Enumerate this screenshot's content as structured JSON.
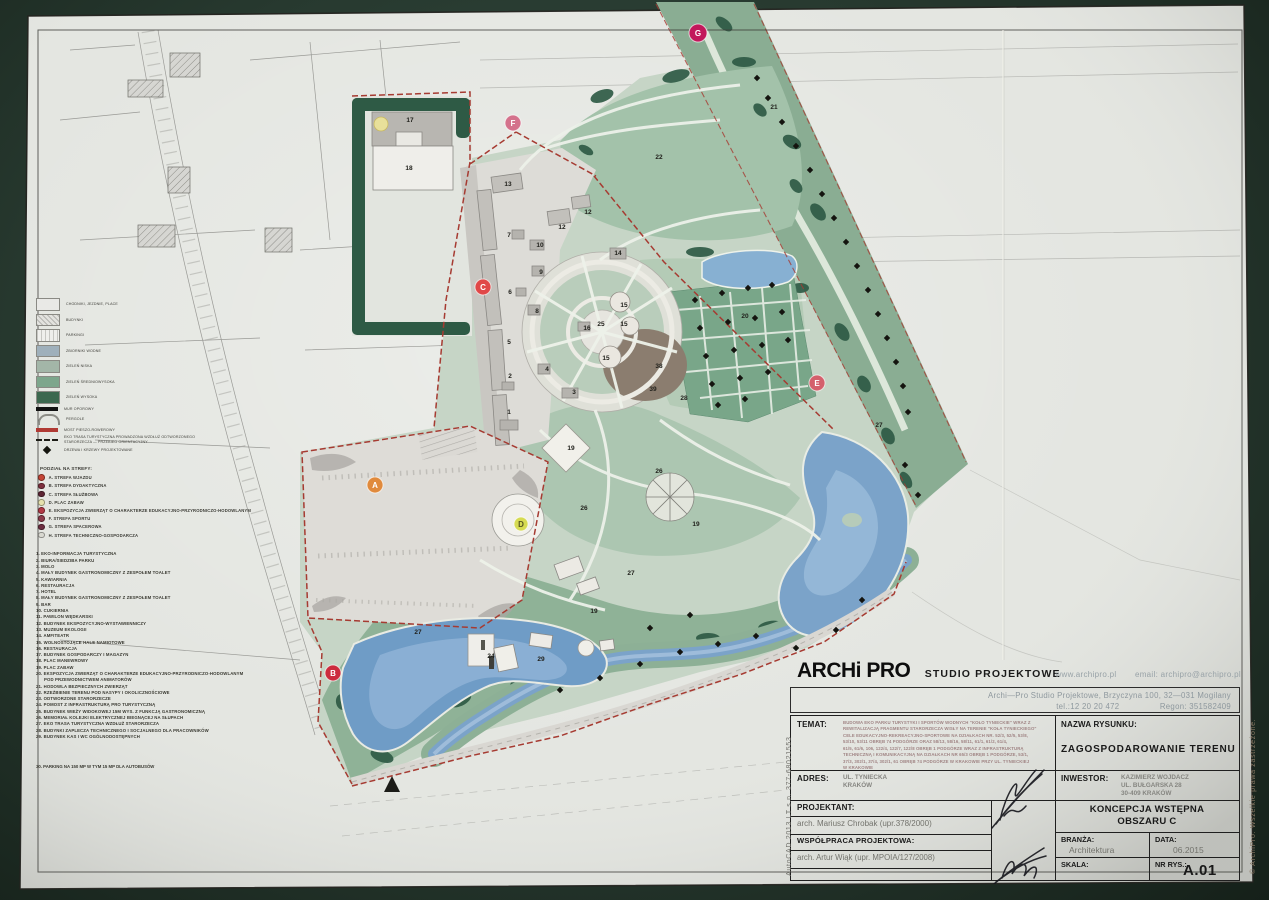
{
  "legend": {
    "rows": [
      {
        "type": "swatch",
        "color": "#e9e9e6",
        "label": "CHODNIKI, JEZDNIE, PLACE"
      },
      {
        "type": "swatch",
        "pattern": "hatch",
        "label": "BUDYNKI"
      },
      {
        "type": "swatch",
        "pattern": "stripes",
        "label": "PARKINGI"
      },
      {
        "type": "swatch",
        "color": "#9fb0bb",
        "label": "ZBIORNIKI WODNE"
      },
      {
        "type": "swatch",
        "color": "#a3b6a8",
        "label": "ZIELEŃ NISKA"
      },
      {
        "type": "swatch",
        "color": "#7da68c",
        "label": "ZIELEŃ ŚREDNIOWYSOKA"
      },
      {
        "type": "swatch",
        "color": "#3c684f",
        "label": "ZIELEŃ WYSOKA"
      },
      {
        "type": "bar",
        "color": "#121212",
        "label": "MUR OPOROWY"
      },
      {
        "type": "arc",
        "label": "PERGOLE"
      },
      {
        "type": "bar",
        "color": "#b03a34",
        "label": "MOST PIESZO-ROWEROWY"
      },
      {
        "type": "dash",
        "label": "EKO TRASA TURYSTYCZNA PROWADZONA WZDŁUŻ ODTWORZONEGO",
        "label2": "STARORZECZA — PRZEBIEG ORIENTACYJNY"
      },
      {
        "type": "diamond",
        "label": "DRZEWA I KRZEWY PROJEKTOWANE"
      }
    ],
    "zones_title": "PODZIAŁ NA STREFY:",
    "zones": [
      {
        "letter": "A",
        "color": "#c44536",
        "label": "STREFA WJAZDU"
      },
      {
        "letter": "B",
        "color": "#7e2f3e",
        "label": "STREFA DYDAKTYCZNA"
      },
      {
        "letter": "C",
        "color": "#5d2433",
        "label": "STREFA SŁUŻBOWA"
      },
      {
        "letter": "D",
        "color": "#e6e2ae",
        "label": "PLAC ZABAW"
      },
      {
        "letter": "E",
        "color": "#b23a46",
        "label": "EKSPOZYCJA ZWIERZĄT O CHARAKTERZE EDUKACYJNO-PRZYRODNICZO-HODOWLANYM"
      },
      {
        "letter": "F",
        "color": "#8d3b4b",
        "label": "STREFA SPORTU"
      },
      {
        "letter": "G",
        "color": "#6d2d40",
        "label": "STREFA SPACEROWA"
      },
      {
        "letter": "H",
        "color": "#d9d9d1",
        "label": "STREFA TECHNICZNO-GOSPODARCZA"
      }
    ],
    "items": [
      {
        "n": "1.",
        "label": "EKO-INFORMACJA TURYSTYCZNA"
      },
      {
        "n": "2.",
        "label": "BIURA/SIEDZIBA PARKU"
      },
      {
        "n": "3.",
        "label": "MOLO"
      },
      {
        "n": "4.",
        "label": "MAŁY BUDYNEK GASTRONOMICZNY Z ZESPOŁEM TOALET"
      },
      {
        "n": "5.",
        "label": "KAWIARNIA"
      },
      {
        "n": "6.",
        "label": "RESTAURACJA"
      },
      {
        "n": "7.",
        "label": "HOTEL"
      },
      {
        "n": "8.",
        "label": "MAŁY BUDYNEK GASTRONOMICZNY Z ZESPOŁEM TOALET"
      },
      {
        "n": "9.",
        "label": "BAR"
      },
      {
        "n": "10.",
        "label": "CUKIERNIA"
      },
      {
        "n": "11.",
        "label": "PAWILON WĘDKARSKI"
      },
      {
        "n": "12.",
        "label": "BUDYNEK EKSPOZYCYJNO-WYSTAWIENNICZY"
      },
      {
        "n": "13.",
        "label": "MUZEUM EKOLOGII"
      },
      {
        "n": "14.",
        "label": "AMFITEATR"
      },
      {
        "n": "15.",
        "label": "WOLNOSTOJĄCE HALE NAMIOTOWE"
      },
      {
        "n": "16.",
        "label": "RESTAURACJA"
      },
      {
        "n": "17.",
        "label": "BUDYNEK GOSPODARCZY I MAGAZYN"
      },
      {
        "n": "18.",
        "label": "PLAC MANEWROWY"
      },
      {
        "n": "19.",
        "label": "PLAC ZABAW"
      },
      {
        "n": "20.",
        "label": "EKSPOZYCJA ZWIERZĄT O CHARAKTERZE EDUKACYJNO-PRZYRODNICZO-HODOWLANYM",
        "label2": "POD PRZEWODNICTWEM ANIMATORÓW"
      },
      {
        "n": "21.",
        "label": "HODOWLA BEZPIECZNYCH ZWIERZĄT"
      },
      {
        "n": "22.",
        "label": "RZEŹBIENIE TERENU POD NASYPY I OKOLICZNOŚCIOWE"
      },
      {
        "n": "23.",
        "label": "ODTWORZONE STARORZECZE"
      },
      {
        "n": "24.",
        "label": "POMOST Z INFRASTRUKTURĄ PRO TURYSTYCZNĄ"
      },
      {
        "n": "25.",
        "label": "BUDYNEK WIEŻY WIDOKOWEJ 15M WYS. Z FUNKCJĄ GASTRONOMICZNĄ"
      },
      {
        "n": "26.",
        "label": "MEMORIAŁ KOLEJKI ELEKTRYCZNEJ BIEGNĄCEJ NA SŁUPACH"
      },
      {
        "n": "27.",
        "label": "EKO TRASA TURYSTYCZNA WZDŁUŻ STARORZECZA"
      },
      {
        "n": "28.",
        "label": "BUDYNKI ZAPLECZA TECHNICZNEGO I SOCJALNEGO DLA PRACOWNIKÓW"
      },
      {
        "n": "29.",
        "label": "BUDYNEK KAS I WC OGÓLNODOSTĘPNYCH"
      }
    ],
    "items_footer": "30. PARKING NA 150 MP W TYM 15 MP DLA AUTOBUSÓW"
  },
  "map": {
    "markers": [
      {
        "letter": "G",
        "x": 698,
        "y": 33,
        "r": 9,
        "color": "#c2185b"
      },
      {
        "letter": "F",
        "x": 513,
        "y": 123,
        "r": 8,
        "color": "#d4728c"
      },
      {
        "letter": "C",
        "x": 483,
        "y": 287,
        "r": 8,
        "color": "#e04848"
      },
      {
        "letter": "E",
        "x": 817,
        "y": 383,
        "r": 8,
        "color": "#d4606c"
      },
      {
        "letter": "A",
        "x": 375,
        "y": 485,
        "r": 8,
        "color": "#e08a3c"
      },
      {
        "letter": "B",
        "x": 333,
        "y": 673,
        "r": 8,
        "color": "#cc2b3d"
      },
      {
        "letter": "D",
        "x": 521,
        "y": 524,
        "r": 7,
        "color": "#d6db52",
        "text": "#55551f"
      }
    ],
    "numbers": [
      {
        "n": "17",
        "x": 410,
        "y": 122
      },
      {
        "n": "18",
        "x": 409,
        "y": 170
      },
      {
        "n": "13",
        "x": 508,
        "y": 186
      },
      {
        "n": "12",
        "x": 562,
        "y": 229
      },
      {
        "n": "12",
        "x": 588,
        "y": 214
      },
      {
        "n": "14",
        "x": 618,
        "y": 255
      },
      {
        "n": "7",
        "x": 509,
        "y": 237
      },
      {
        "n": "10",
        "x": 540,
        "y": 247
      },
      {
        "n": "9",
        "x": 541,
        "y": 274
      },
      {
        "n": "6",
        "x": 510,
        "y": 294
      },
      {
        "n": "8",
        "x": 537,
        "y": 313
      },
      {
        "n": "16",
        "x": 587,
        "y": 330
      },
      {
        "n": "25",
        "x": 601,
        "y": 326
      },
      {
        "n": "15",
        "x": 624,
        "y": 307
      },
      {
        "n": "15",
        "x": 624,
        "y": 326
      },
      {
        "n": "15",
        "x": 606,
        "y": 360
      },
      {
        "n": "5",
        "x": 509,
        "y": 344
      },
      {
        "n": "4",
        "x": 547,
        "y": 371
      },
      {
        "n": "2",
        "x": 510,
        "y": 378
      },
      {
        "n": "3",
        "x": 574,
        "y": 394
      },
      {
        "n": "1",
        "x": 509,
        "y": 414
      },
      {
        "n": "38",
        "x": 659,
        "y": 368
      },
      {
        "n": "39",
        "x": 653,
        "y": 391
      },
      {
        "n": "22",
        "x": 659,
        "y": 159
      },
      {
        "n": "21",
        "x": 774,
        "y": 109
      },
      {
        "n": "20",
        "x": 745,
        "y": 318
      },
      {
        "n": "27",
        "x": 879,
        "y": 427
      },
      {
        "n": "19",
        "x": 571,
        "y": 450
      },
      {
        "n": "19",
        "x": 696,
        "y": 526
      },
      {
        "n": "19",
        "x": 594,
        "y": 613
      },
      {
        "n": "26",
        "x": 584,
        "y": 510
      },
      {
        "n": "26",
        "x": 659,
        "y": 473
      },
      {
        "n": "28",
        "x": 684,
        "y": 400
      },
      {
        "n": "27",
        "x": 631,
        "y": 575
      },
      {
        "n": "24",
        "x": 491,
        "y": 658
      },
      {
        "n": "27",
        "x": 418,
        "y": 634
      },
      {
        "n": "29",
        "x": 541,
        "y": 661
      }
    ],
    "trees": [
      [
        695,
        300
      ],
      [
        722,
        293
      ],
      [
        748,
        288
      ],
      [
        772,
        285
      ],
      [
        700,
        328
      ],
      [
        728,
        322
      ],
      [
        755,
        318
      ],
      [
        782,
        312
      ],
      [
        706,
        356
      ],
      [
        734,
        350
      ],
      [
        762,
        345
      ],
      [
        788,
        340
      ],
      [
        712,
        384
      ],
      [
        740,
        378
      ],
      [
        768,
        372
      ],
      [
        718,
        405
      ],
      [
        745,
        399
      ],
      [
        757,
        78
      ],
      [
        768,
        98
      ],
      [
        782,
        122
      ],
      [
        796,
        146
      ],
      [
        810,
        170
      ],
      [
        822,
        194
      ],
      [
        834,
        218
      ],
      [
        846,
        242
      ],
      [
        857,
        266
      ],
      [
        868,
        290
      ],
      [
        878,
        314
      ],
      [
        887,
        338
      ],
      [
        896,
        362
      ],
      [
        903,
        386
      ],
      [
        908,
        412
      ],
      [
        560,
        690
      ],
      [
        600,
        678
      ],
      [
        640,
        664
      ],
      [
        680,
        652
      ],
      [
        718,
        644
      ],
      [
        756,
        636
      ],
      [
        796,
        648
      ],
      [
        836,
        630
      ],
      [
        862,
        600
      ],
      [
        690,
        615
      ],
      [
        650,
        628
      ],
      [
        905,
        465
      ],
      [
        918,
        495
      ]
    ]
  },
  "title_block": {
    "logo": "ARCHi PRO",
    "logo_suffix": "STUDIO PROJEKTOWE",
    "web": "www.archipro.pl",
    "email": "email:  archipro@archipro.pl",
    "addr_line1": "Archi—Pro  Studio  Projektowe,  Brzyczyna  100,  32—031  Mogilany",
    "addr_tel": "tel.:12  20  20  472",
    "addr_regon": "Regon: 351582409",
    "temat_label": "TEMAT:",
    "temat_lines": [
      "BUDOWA EKO PARKU TURYSTYKI I SPORTÓW WODNYCH \"KOŁO TYNIECKIE\" WRAZ Z",
      "REWITALIZACJĄ FRAGMENTU STARORZECZA WISŁY NA TERENIE \"KOŁA TYNIECKIEGO\"",
      "CELE EDUKACYJNO-REKREACYJNO-SPORTOWE NA DZIAŁKACH NR. 52/3, 52/5, 53/8,",
      "53/10, 53/11 OBRĘB 74 PODGÓRZE ORAZ 58/13, 58/16, 58/11, 61/1, 61/2, 61/4,",
      "61/5, 61/6, 106, 122/4, 122/7, 122/8 OBRĘB 1 PODGÓRZE WRAZ Z INFRASTRUKTURĄ",
      "TECHNICZNĄ I KOMUNIKACYJNĄ NA DZIAŁKACH NR 65/3 OBRĘB 1 PODGÓRZE, 53/1,",
      "37/3, 302/1, 37/4, 302/1, 61 OBRĘB 74 PODGÓRZE W KRAKOWIE PRZY UL. TYNIECKIEJ",
      "W KRAKOWIE"
    ],
    "nazwa_label": "NAZWA RYSUNKU:",
    "nazwa_value": "ZAGOSPODAROWANIE TERENU",
    "adres_label": "ADRES:",
    "adres_line1": "UL. TYNIECKA",
    "adres_line2": "KRAKÓW",
    "inwestor_label": "INWESTOR:",
    "inwestor_line1": "KAZIMIERZ WOJDACZ",
    "inwestor_line2": "UL. BUŁGARSKA 28",
    "inwestor_line3": "30-409 KRAKÓW",
    "projektant_label": "PROJEKTANT:",
    "projektant_value": "arch.  Mariusz  Chrobak    (upr.378/2000)",
    "wspolpraca_label": "WSPÓŁPRACA PROJEKTOWA:",
    "wspolpraca_value": "arch.  Artur  Wiąk  (upr.  MPOIA/127/2008)",
    "koncepcja_line1": "KONCEPCJA WSTĘPNA",
    "koncepcja_line2": "OBSZARU C",
    "branza_label": "BRANŻA:",
    "branza_value": "Architektura",
    "data_label": "DATA:",
    "data_value": "06.2015",
    "skala_label": "SKALA:",
    "nr_label": "NR RYS.:",
    "nr_value": "A.01"
  },
  "edge_notes": {
    "left": "AutoCAD  2013  LT   s.n.  377-68021553",
    "right": "© ArchiPro.   Wszelkie  prawa  zastrzeżone."
  }
}
